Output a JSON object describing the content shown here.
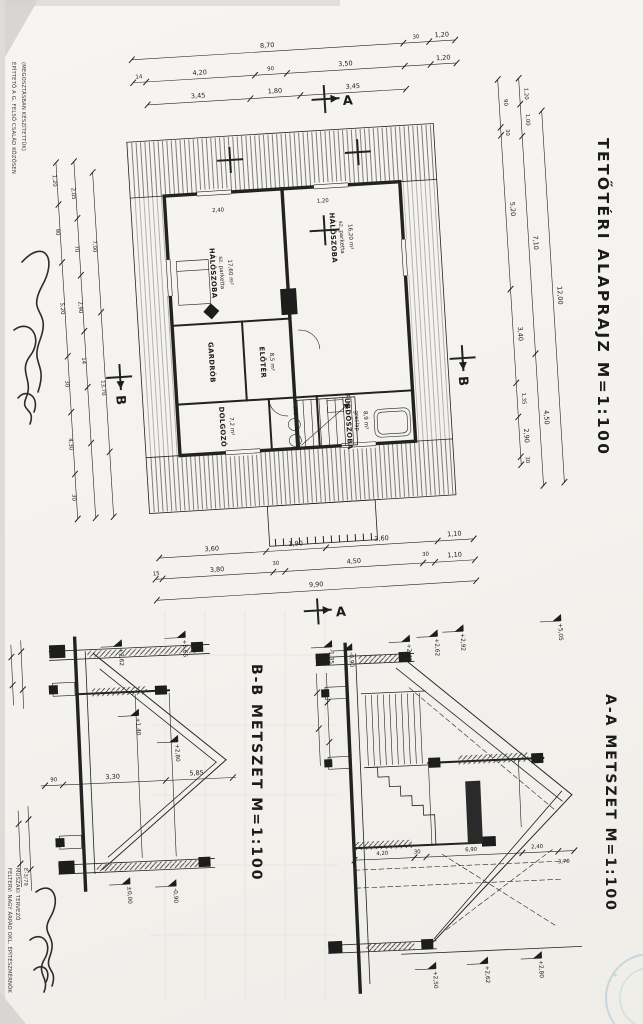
{
  "titles": {
    "plan": "TETŐTÉRI ALAPRAJZ M=1:100",
    "section_a": "A-A METSZET M=1:100",
    "section_b": "B-B METSZET M=1:100"
  },
  "notes": {
    "owner_line1": "ÉPÍTTETŐ A G. FELSŐ CSALÁD KÖZÖSEN",
    "owner_line2": "(MEGOSZTÁSBAN KÉSZÍTETTÜK)",
    "architect_line1": "FELTERV: NAGY ÁRPÁD OKL. ÉPÍTÉSZMÉRNÖK",
    "architect_line2": "MŰSZAKI TERVEZŐ",
    "architect_line3": "É-3/79"
  },
  "markers": {
    "a": "A",
    "b": "B"
  },
  "rooms": {
    "haloszoba1": {
      "name": "HÁLÓSZOBA",
      "floor": "sz. parketta",
      "area": "17,60 m²"
    },
    "haloszoba2": {
      "name": "HÁLÓSZOBA",
      "floor": "sz. parketta",
      "area": "16,20 m²"
    },
    "eloter": {
      "name": "ELŐTÉR",
      "area": "8,5 m²"
    },
    "gardrob": {
      "name": "GARDRÓB"
    },
    "dolgozo": {
      "name": "DOLGOZÓ",
      "area": "7,2 m²"
    },
    "furdoszoba": {
      "name": "FÜRDŐSZOBA",
      "floor": "greslap",
      "area": "8,9 m²"
    },
    "wc": {
      "name": "WC"
    }
  },
  "dimensions": {
    "top_row1": [
      "8,70",
      "30",
      "1,20"
    ],
    "top_row2": [
      "14",
      "4,20",
      "90",
      "3,50",
      "1,20"
    ],
    "top_row3": [
      "3,45",
      "1,80",
      "3,45"
    ],
    "inner": [
      "2,40",
      "1,20"
    ],
    "bottom_row1": [
      "3,60",
      "1,90",
      "3,60",
      "1,10"
    ],
    "bottom_row2": [
      "15",
      "3,80",
      "30",
      "4,50",
      "30",
      "1,10"
    ],
    "bottom_row3": [
      "9,90"
    ],
    "right_row1": [
      "90",
      "30",
      "5,20",
      "3,40",
      "1,35",
      "2,90",
      "30"
    ],
    "right_row2": [
      "1,20",
      "1,00",
      "7,10",
      "4,50"
    ],
    "right_row3": [
      "12,00"
    ],
    "left_col": [
      "1,20",
      "90",
      "5,20",
      "30",
      "4,30",
      "30",
      "2,05",
      "70",
      "2,90",
      "14",
      "7,00",
      "13,70"
    ],
    "section_b_chain": [
      "90",
      "3,30",
      "5,85"
    ],
    "section_a_chain": [
      "4,20",
      "30",
      "6,90",
      "2,40",
      "3,70"
    ]
  },
  "levels": {
    "section_a": [
      "-1,35",
      "-0,90",
      "+2,40",
      "+2,62",
      "+2,92",
      "+5,05",
      "+2,50",
      "+2,62",
      "+2,80"
    ],
    "section_b": [
      "+2,62",
      "+5,65",
      "+2,80",
      "+1,40",
      "±0,00",
      "-0,90"
    ]
  }
}
